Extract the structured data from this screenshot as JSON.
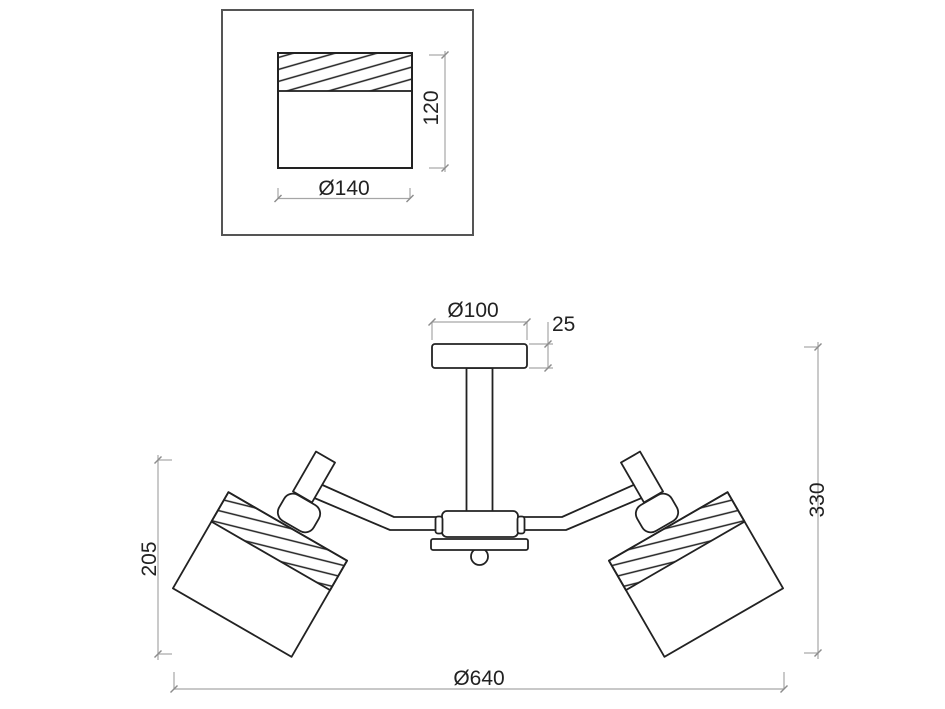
{
  "drawing": {
    "detail_view": {
      "width_label": "Ø140",
      "height_label": "120"
    },
    "main_view": {
      "canopy_width_label": "Ø100",
      "canopy_height_label": "25",
      "overall_height_label": "330",
      "shade_drop_label": "205",
      "overall_width_label": "Ø640"
    },
    "colors": {
      "outline": "#222222",
      "dimension_line": "#a6a6a6",
      "dimension_serif": "#8c8c8c",
      "detail_frame": "#555555",
      "background": "#ffffff"
    }
  }
}
